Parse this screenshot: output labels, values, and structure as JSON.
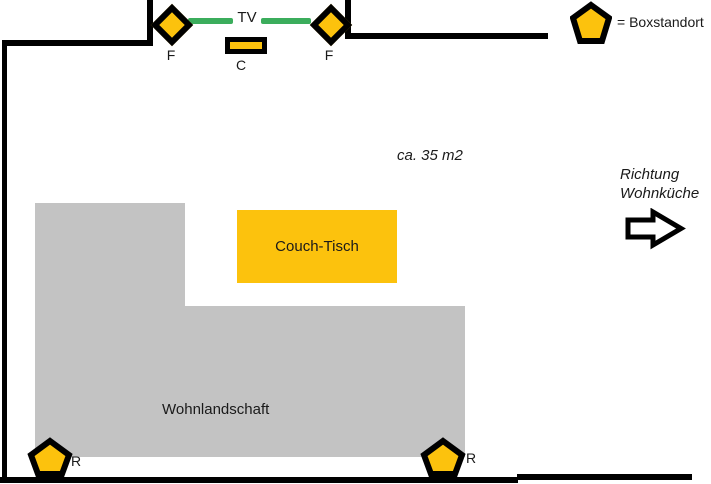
{
  "legend": {
    "label": "= Boxstandort"
  },
  "annotations": {
    "area": "ca. 35 m2",
    "direction_line1": "Richtung",
    "direction_line2": "Wohnküche"
  },
  "tv_unit": {
    "tv_label": "TV",
    "center_speaker_label": "C",
    "front_left_label": "F",
    "front_right_label": "F"
  },
  "rear_speakers": {
    "left_label": "R",
    "right_label": "R"
  },
  "furniture": {
    "coffee_table_label": "Couch-Tisch",
    "sofa_label": "Wohnlandschaft"
  },
  "colors": {
    "speaker_yellow": "#fcc20d",
    "sofa_gray": "#c3c3c3",
    "tv_green": "#3bad5c",
    "wall_black": "#000000"
  }
}
